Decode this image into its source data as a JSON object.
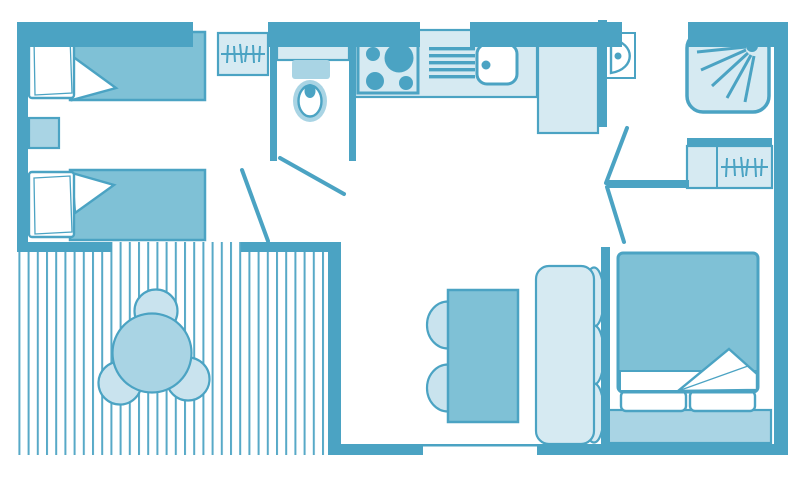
{
  "title": "mobile-home-floor-plan",
  "colors": {
    "background": "#FFFFFF",
    "wall": "#4BA3C3",
    "mid": "#7FC1D6",
    "medlight": "#A9D4E4",
    "light": "#D6EAF2",
    "chairlight": "#C9E3EE",
    "deck_stripe": "#57A9C7"
  },
  "floorplan": {
    "rooms": [
      {
        "name": "twin-bedroom",
        "furniture": [
          "single-bed",
          "single-bed",
          "nightstand",
          "wardrobe-hangers"
        ]
      },
      {
        "name": "toilet-room",
        "furniture": [
          "washbasin-counter",
          "cistern",
          "toilet"
        ]
      },
      {
        "name": "kitchen",
        "furniture": [
          "hob-4-burners",
          "draining-board",
          "sink",
          "tall-unit-fridge"
        ]
      },
      {
        "name": "shower-room",
        "furniture": [
          "washbasin",
          "shower-tray"
        ]
      },
      {
        "name": "hall",
        "furniture": [
          "wardrobe-hangers"
        ]
      },
      {
        "name": "living-dining",
        "furniture": [
          "dining-table",
          "chair",
          "chair",
          "bench-sofa"
        ]
      },
      {
        "name": "master-bedroom",
        "furniture": [
          "double-bed",
          "pillows",
          "headboard"
        ]
      },
      {
        "name": "terrace-deck",
        "furniture": [
          "round-table",
          "chair",
          "chair",
          "chair"
        ]
      }
    ],
    "doors": [
      "twin-bedroom-door",
      "toilet-door",
      "master-bedroom-door-upper",
      "master-bedroom-door-lower"
    ],
    "icons": [
      "hanger-icon",
      "shower-spray-icon",
      "burner-icon",
      "drain-lines-icon",
      "sink-icon",
      "toilet-icon"
    ]
  }
}
